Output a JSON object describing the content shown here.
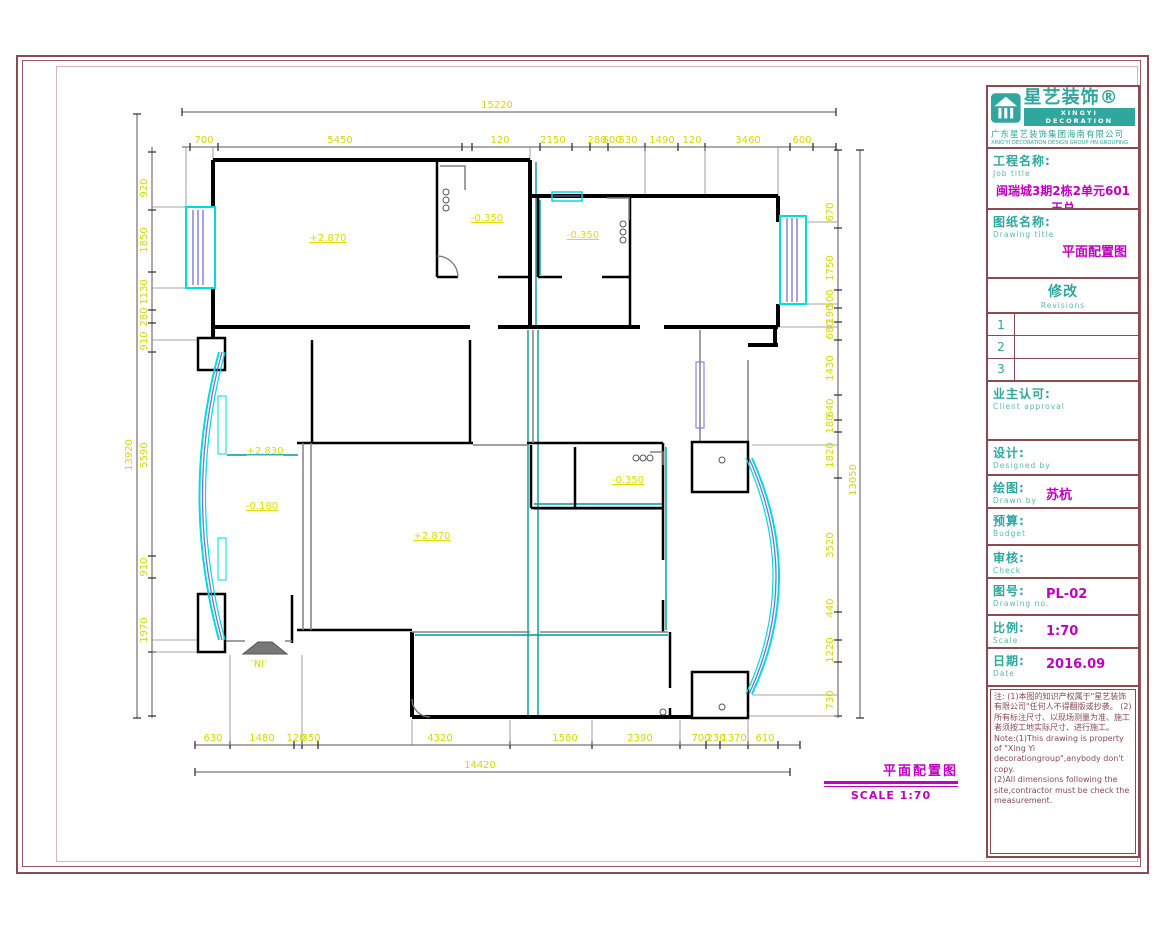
{
  "title_block": {
    "logo": {
      "brand_cn": "星艺装饰®",
      "brand_en": "XINGYI DECORATION",
      "company_cn": "广东星艺装饰集团海南有限公司",
      "company_en": "XING'YI DECORATION DESIGN GROUP HN.GROUPING"
    },
    "job": {
      "label_cn": "工程名称:",
      "label_en": "Job title",
      "value": "闽瑞城3期2栋2单元601王总"
    },
    "drawing": {
      "label_cn": "图纸名称:",
      "label_en": "Drawing title",
      "value": "平面配置图"
    },
    "revisions": {
      "label_cn": "修改",
      "label_en": "Revisions",
      "rows": [
        "1",
        "2",
        "3"
      ]
    },
    "client": {
      "label_cn": "业主认可:",
      "label_en": "Client approval"
    },
    "designed": {
      "label_cn": "设计:",
      "label_en": "Designed by"
    },
    "drawn": {
      "label_cn": "绘图:",
      "label_en": "Drawn by",
      "value": "苏杭"
    },
    "budget": {
      "label_cn": "预算:",
      "label_en": "Budget"
    },
    "check": {
      "label_cn": "审核:",
      "label_en": "Check"
    },
    "drawing_no": {
      "label_cn": "图号:",
      "label_en": "Drawing no.",
      "value": "PL-02"
    },
    "scale": {
      "label_cn": "比例:",
      "label_en": "Scale",
      "value": "1:70"
    },
    "date": {
      "label_cn": "日期:",
      "label_en": "Date",
      "value": "2016.09"
    },
    "notes_cn": "注: (1)本图的知识产权属于\"星艺装饰有限公司\"任何人不得翻版或抄袭。 (2)所有标注尺寸、以现场测量为准、施工者须按工地实际尺寸、进行施工。",
    "notes_en_1": "Note:(1)This drawing is property of \"Xing Yi decorationgroup\",anybody don't copy.",
    "notes_en_2": "(2)All dimensions following the site,contractor must be check the measurement."
  },
  "plan": {
    "caption": {
      "title": "平面配置图",
      "scale_text": "SCALE  1:70"
    },
    "entrance_label": ".IN.",
    "levels": [
      "+2.870",
      "-0.350",
      "-0.350",
      "+2.830",
      "-0.180",
      "+2.870",
      "-0.350"
    ],
    "dims": {
      "top": {
        "total": "15220",
        "segments": [
          "700",
          "5450",
          "120",
          "2150",
          "280",
          "600",
          "530",
          "1490",
          "120",
          "3460",
          "600"
        ]
      },
      "left": {
        "total": "13920",
        "segments": [
          "920",
          "1850",
          "1130",
          "280",
          "910",
          "5590",
          "910",
          "1970"
        ]
      },
      "right": {
        "total": "13050",
        "segments": [
          "670",
          "1750",
          "500",
          "190",
          "680",
          "1430",
          "640",
          "180",
          "1820",
          "3520",
          "440",
          "1220",
          "730"
        ]
      },
      "bottom": {
        "total": "14420",
        "segments": [
          "630",
          "1480",
          "120",
          "350",
          "4320",
          "1580",
          "2390",
          "700",
          "230",
          "1370",
          "610"
        ]
      }
    }
  },
  "colors": {
    "accent_teal": "#2fa79e",
    "accent_magenta": "#c000c0",
    "border_maroon": "#8a4a52",
    "dim_yellow": "#d8d800",
    "window_cyan": "#00dcdc",
    "glazing_purple": "#7272d8"
  }
}
